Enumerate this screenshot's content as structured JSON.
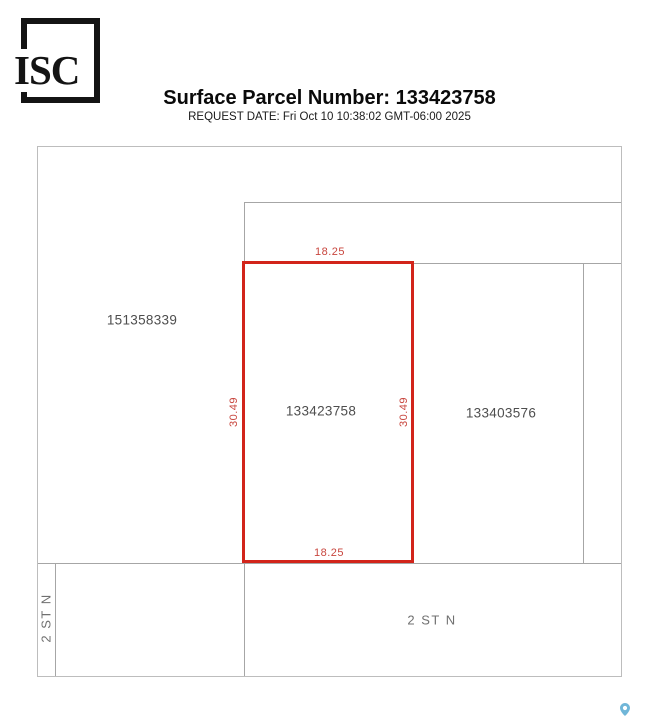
{
  "logo": {
    "text": "ISC"
  },
  "header": {
    "title": "Surface Parcel Number: 133423758",
    "request_date": "REQUEST DATE: Fri Oct 10 10:38:02 GMT-06:00 2025"
  },
  "map": {
    "parcels": [
      {
        "id": "151358339",
        "highlighted": false
      },
      {
        "id": "133423758",
        "highlighted": true
      },
      {
        "id": "133403576",
        "highlighted": false
      }
    ],
    "dimensions": {
      "top": "18.25",
      "bottom": "18.25",
      "left": "30.49",
      "right": "30.49"
    },
    "streets": [
      {
        "label": "2 ST N",
        "orientation": "vertical-left"
      },
      {
        "label": "2 ST N",
        "orientation": "horizontal-bottom"
      }
    ]
  },
  "icons": {
    "map_pin": {
      "name": "map-pin-icon",
      "color": "#70b6d8"
    }
  },
  "theme": {
    "highlight-red": "#d2241a",
    "dim-label-red": "#c8463e",
    "line-gray": "#a6a6a6",
    "border-gray": "#bdbdbd",
    "parcel-label-gray": "#4e4e4e",
    "street-label-gray": "#707070",
    "pin-blue": "#70b6d8",
    "title-black": "#0a0a0a"
  }
}
